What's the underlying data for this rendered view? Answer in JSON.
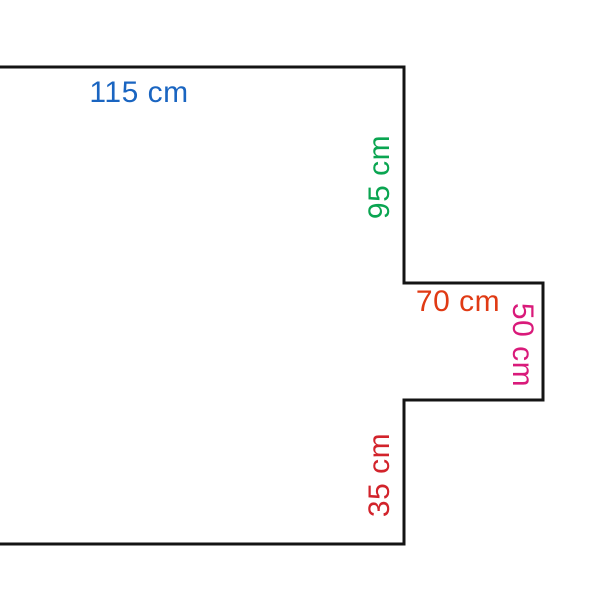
{
  "figure": {
    "description": "Outline of an irregular rectilinear shape, open at the left image edge, with a rectangular notch on the right side and five colored dimension labels",
    "background_color": "#ffffff",
    "outline_color": "#141414",
    "labels": [
      {
        "id": "top-width",
        "text": "115 cm",
        "value": 115,
        "unit": "cm",
        "color": "#1a65c1",
        "orientation": "horizontal"
      },
      {
        "id": "upper-right-height",
        "text": "95 cm",
        "value": 95,
        "unit": "cm",
        "color": "#0aa551",
        "orientation": "vertical-bottom-up"
      },
      {
        "id": "notch-width",
        "text": "70 cm",
        "value": 70,
        "unit": "cm",
        "color": "#e03a14",
        "orientation": "horizontal"
      },
      {
        "id": "notch-height",
        "text": "50 cm",
        "value": 50,
        "unit": "cm",
        "color": "#d91a7a",
        "orientation": "vertical-top-down"
      },
      {
        "id": "lower-right-height",
        "text": "35 cm",
        "value": 35,
        "unit": "cm",
        "color": "#d2232b",
        "orientation": "vertical-bottom-up"
      }
    ]
  }
}
